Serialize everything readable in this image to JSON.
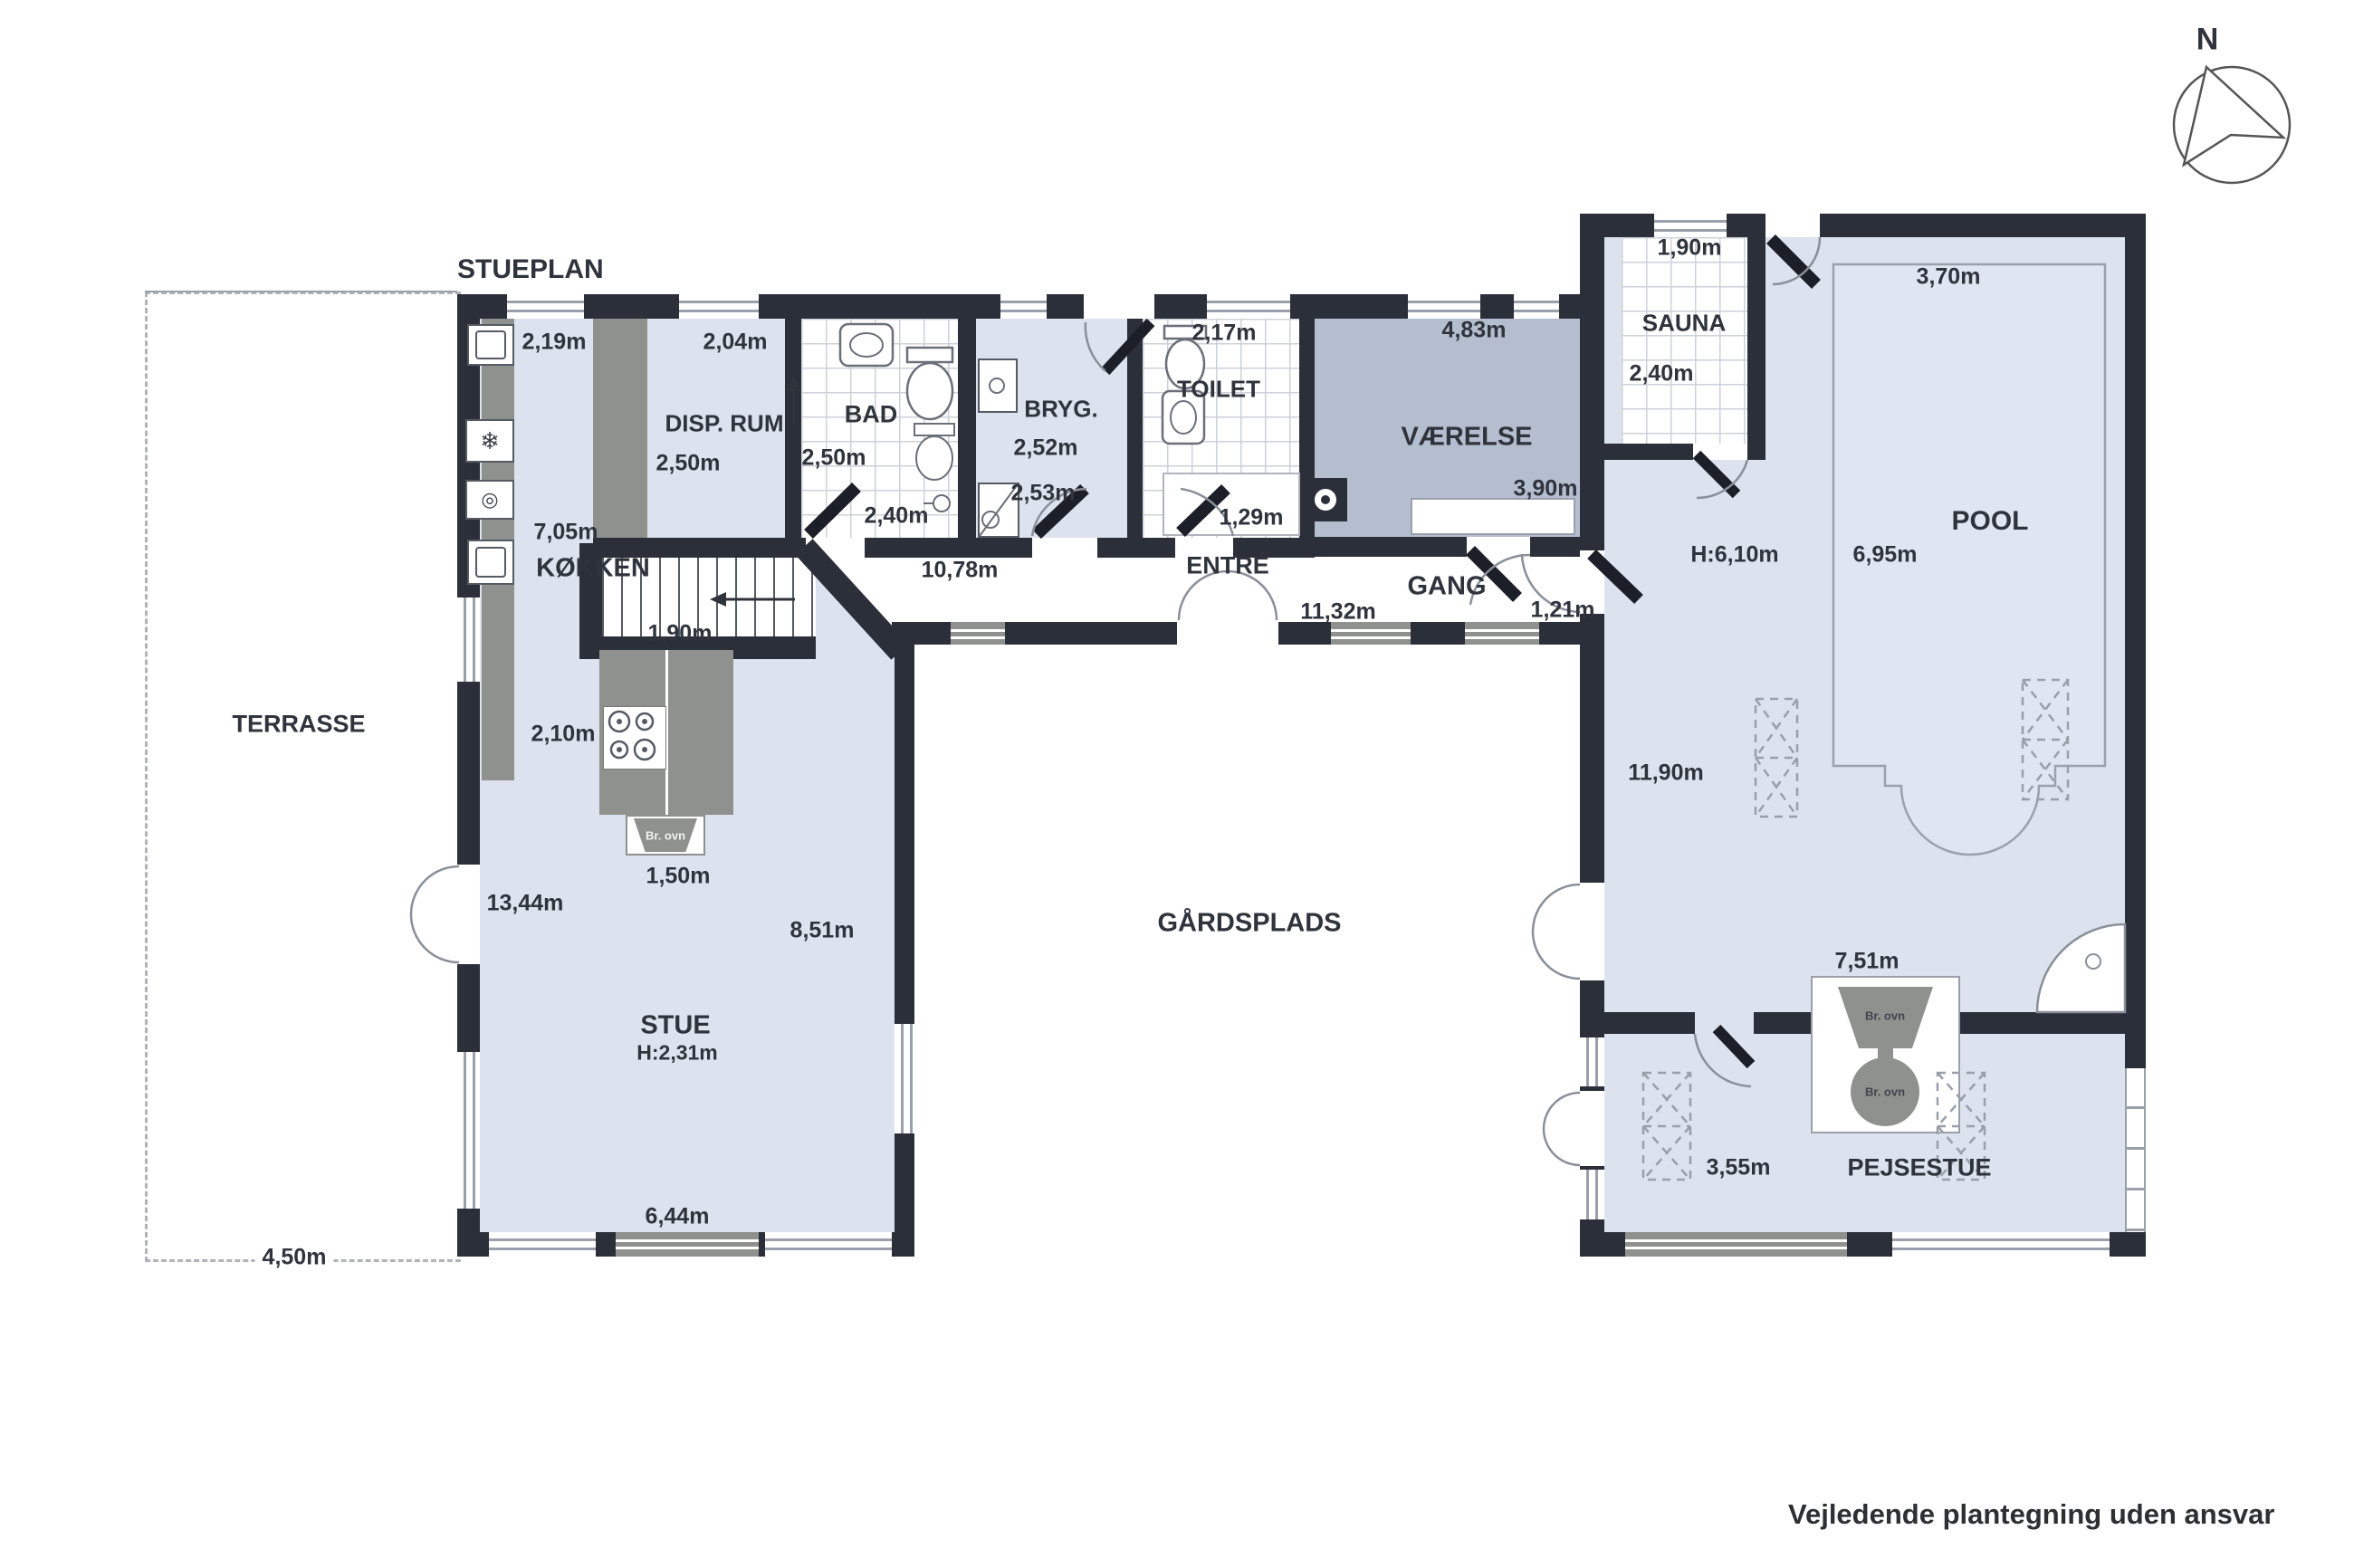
{
  "title": "STUEPLAN",
  "footer": "Vejledende plantegning uden ansvar",
  "compass": {
    "north": "N"
  },
  "outdoor": {
    "terrasse": "TERRASSE",
    "terrasse_width": "4,50m",
    "gaardsplads": "GÅRDSPLADS"
  },
  "kitchen": {
    "label": "KØKKEN",
    "top_width": "2,19m",
    "counter_len": "7,05m",
    "island_width": "1,90m",
    "island_depth": "2,10m",
    "oven_width": "1,50m",
    "oven": "Br. ovn"
  },
  "disp_rum": {
    "label": "DISP. RUM",
    "width": "2,04m",
    "depth": "2,50m"
  },
  "bad": {
    "label": "BAD",
    "depth": "2,50m",
    "width": "2,40m"
  },
  "hall_top": {
    "length": "10,78m"
  },
  "bryg": {
    "label": "BRYG.",
    "d1": "2,52m",
    "d2": "2,53m"
  },
  "toilet": {
    "label": "TOILET",
    "width": "2,17m"
  },
  "closet": {
    "width": "1,29m"
  },
  "vaerelse": {
    "label": "VÆRELSE",
    "width": "4,83m",
    "depth": "3,90m"
  },
  "entre": {
    "label": "ENTRÉ"
  },
  "gang": {
    "label": "GANG",
    "length": "11,32m",
    "door": "1,21m"
  },
  "stue": {
    "label": "STUE",
    "height": "H:2,31m",
    "depth": "8,51m",
    "side": "13,44m",
    "window": "6,44m"
  },
  "sauna": {
    "label": "SAUNA",
    "width": "1,90m",
    "depth": "2,40m"
  },
  "pool_room": {
    "label": "POOL",
    "pool_width": "3,70m",
    "ceiling": "H:6,10m",
    "pool_length": "6,95m",
    "room_length": "11,90m"
  },
  "pejsestue": {
    "label": "PEJSESTUE",
    "wall": "7,51m",
    "depth": "3,55m",
    "stove": "Br. ovn"
  }
}
